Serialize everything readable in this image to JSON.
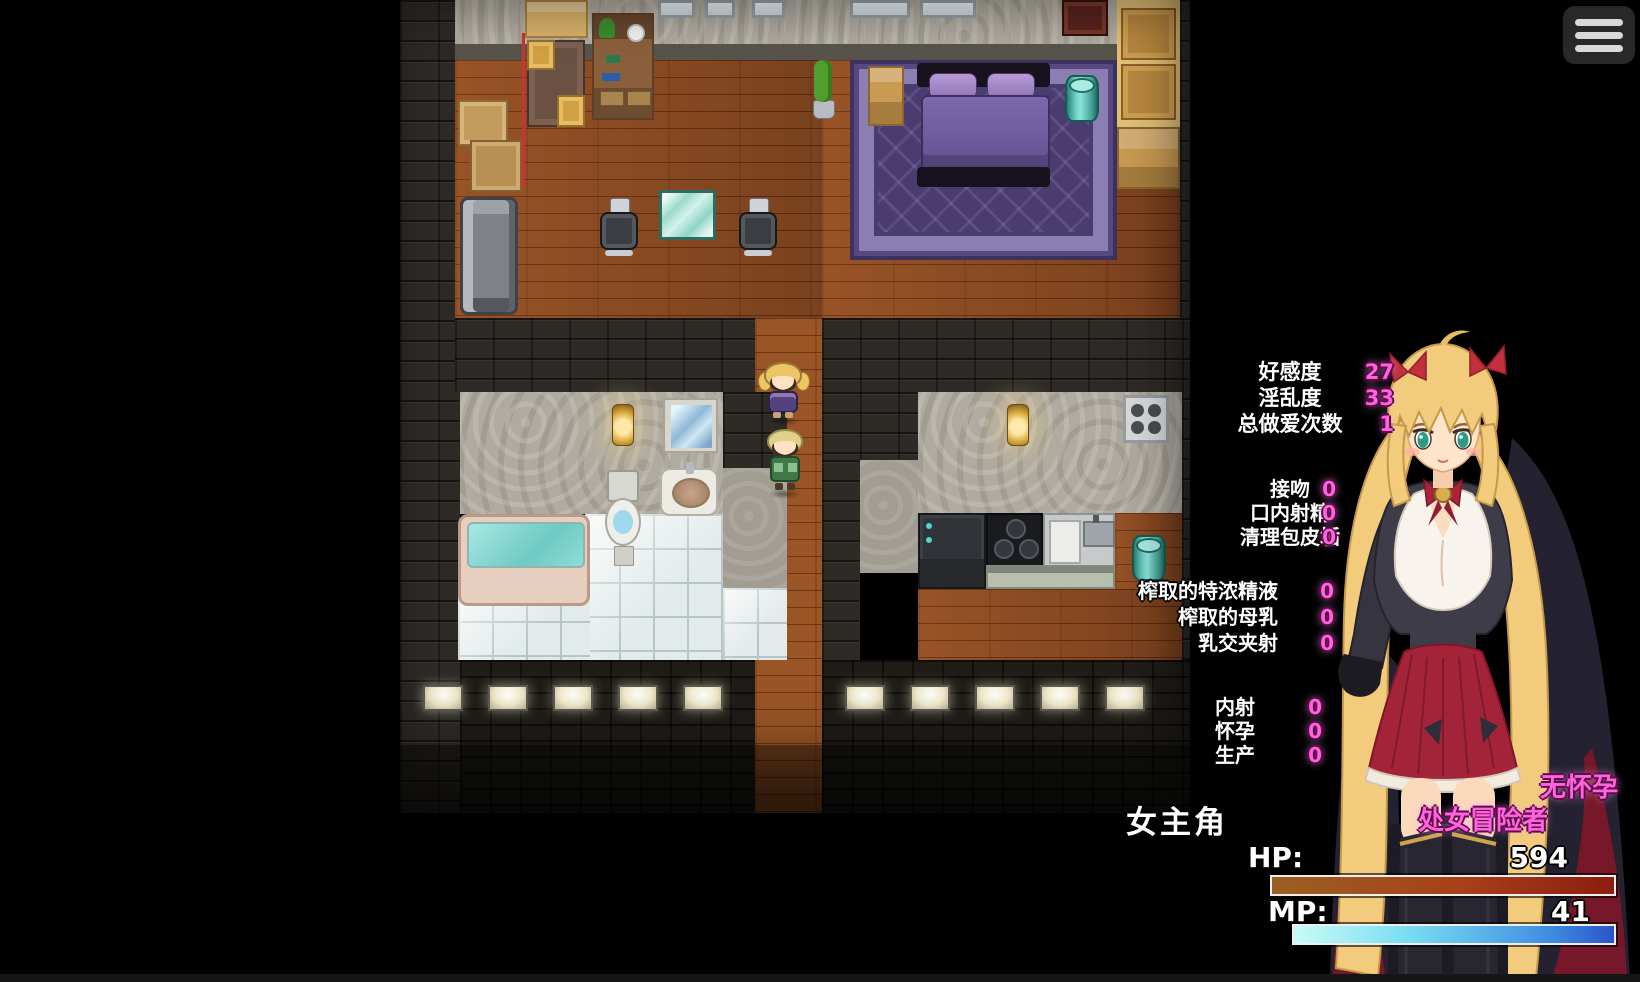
{
  "menu": {
    "icon": "hamburger-menu-icon"
  },
  "stats": {
    "groups": [
      {
        "rows": [
          {
            "label": "好感度",
            "value": "27"
          },
          {
            "label": "淫乱度",
            "value": "33"
          },
          {
            "label": "总做爱次数",
            "value": "1"
          }
        ]
      },
      {
        "rows": [
          {
            "label": "接吻",
            "value": "0"
          },
          {
            "label": "口内射精",
            "value": "0"
          },
          {
            "label": "清理包皮垢",
            "value": "0"
          }
        ]
      },
      {
        "rows": [
          {
            "label": "榨取的特浓精液",
            "value": "0"
          },
          {
            "label": "榨取的母乳",
            "value": "0"
          },
          {
            "label": "乳交夹射",
            "value": "0"
          }
        ]
      },
      {
        "rows": [
          {
            "label": "内射",
            "value": "0"
          },
          {
            "label": "怀孕",
            "value": "0"
          },
          {
            "label": "生产",
            "value": "0"
          }
        ]
      }
    ]
  },
  "character": {
    "name": "女主角",
    "tags": [
      "无怀孕",
      "处女冒险者"
    ],
    "hp_label": "HP:",
    "hp_value": "594",
    "mp_label": "MP:",
    "mp_value": "41"
  },
  "colors": {
    "stat_value_pink": "#ff63dd",
    "tag_pink": "#ff86e4",
    "hp_bar": [
      "#9a6022",
      "#a84018",
      "#8c1d10"
    ],
    "mp_bar": [
      "#c8fbf6",
      "#2b55c8"
    ]
  }
}
